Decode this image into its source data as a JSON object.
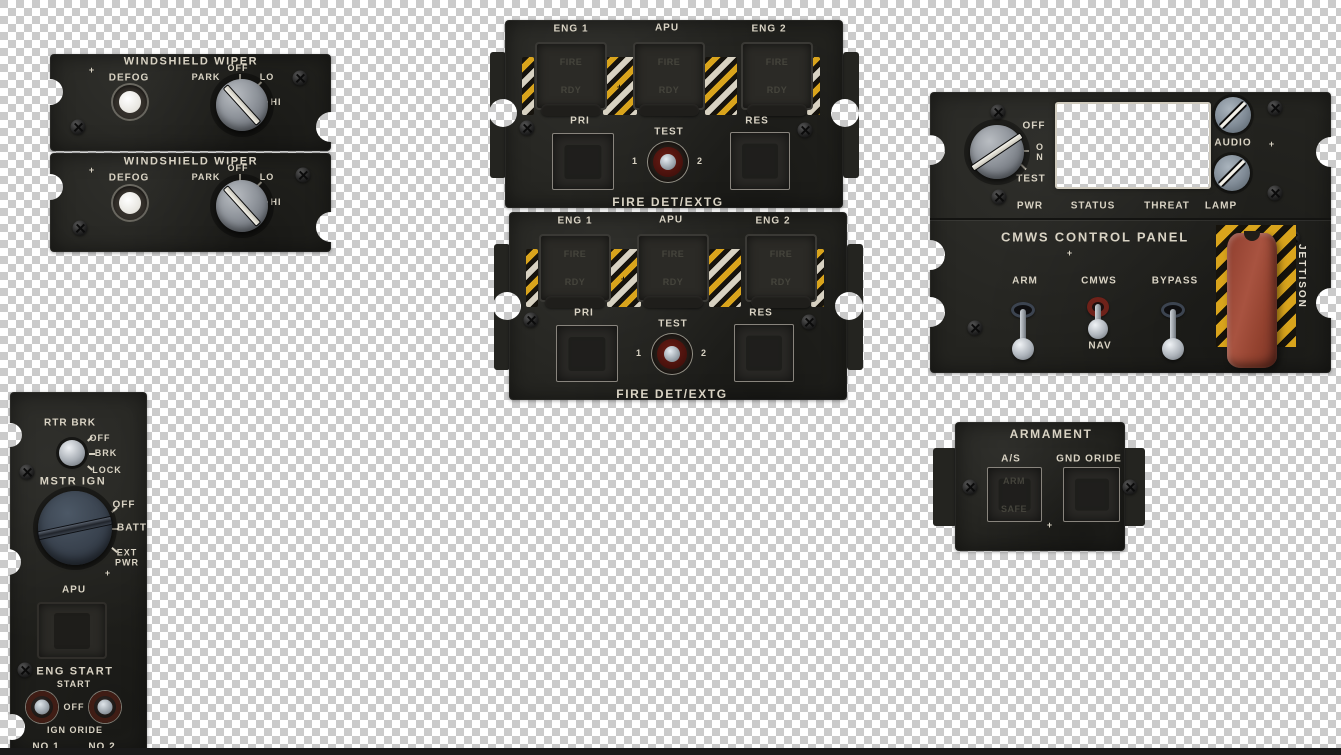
{
  "background": {
    "checker_light": "#ffffff",
    "checker_dark": "#cbcbcb",
    "bottom_strip_color": "#1a1a1a"
  },
  "colors": {
    "panel_black": "#242420",
    "label_cream": "#d9d3c4",
    "hazard_yellow": "#d9a41c",
    "hazard_white": "#d8d2c2",
    "jettison_handle_red": "#a85340",
    "test_ring_red": "#6b1d15"
  },
  "panels": {
    "windshield": {
      "title": "WINDSHIELD WIPER",
      "plus": "+",
      "defog_label": "DEFOG",
      "knob_positions": {
        "park": "PARK",
        "off": "OFF",
        "lo": "LO",
        "hi": "HI"
      }
    },
    "fire": {
      "eng1": "ENG 1",
      "apu": "APU",
      "eng2": "ENG 2",
      "fire_faint": "FIRE",
      "rdy_faint": "RDY",
      "plus": "+",
      "pri": "PRI",
      "test": "TEST",
      "res": "RES",
      "test_left": "1",
      "test_right": "2",
      "footer": "FIRE DET/EXTG"
    },
    "cmws": {
      "knob_positions": {
        "off": "OFF",
        "o": "O",
        "n": "N",
        "test": "TEST"
      },
      "audio": "AUDIO",
      "plus_top": "+",
      "bottom_labels": {
        "pwr": "PWR",
        "status": "STATUS",
        "threat": "THREAT",
        "lamp": "LAMP"
      },
      "title": "CMWS CONTROL PANEL",
      "plus_mid": "+",
      "arm": "ARM",
      "cmws": "CMWS",
      "bypass": "BYPASS",
      "nav": "NAV",
      "jettison": "JETTISON"
    },
    "armament": {
      "title": "ARMAMENT",
      "as_label": "A/S",
      "gnd_oride": "GND ORIDE",
      "arm_faint": "ARM",
      "safe_faint": "SAFE",
      "plus": "+"
    },
    "left_console": {
      "rtr_brk": "RTR BRK",
      "rtr_positions": {
        "off": "OFF",
        "brk": "BRK",
        "lock": "LOCK"
      },
      "mstr_ign": "MSTR IGN",
      "ign_positions": {
        "off": "OFF",
        "batt": "BATT",
        "ext_pwr": "EXT\nPWR"
      },
      "plus": "+",
      "apu": "APU",
      "eng_start": "ENG START",
      "start": "START",
      "off": "OFF",
      "ign_oride": "IGN ORIDE",
      "no1": "NO 1",
      "no2": "NO 2"
    }
  }
}
